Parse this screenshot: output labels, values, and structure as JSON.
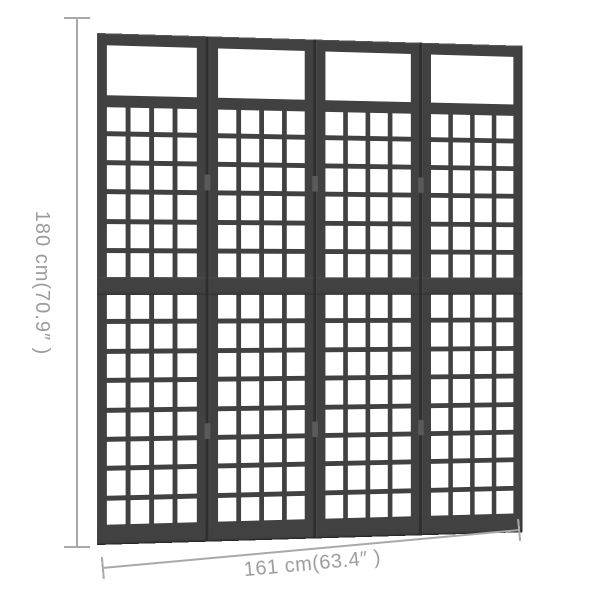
{
  "page": {
    "background": "#ffffff"
  },
  "divider": {
    "panel_count": 4,
    "columns_per_panel": 4,
    "upper_grid_rows": 6,
    "lower_grid_rows": 8,
    "hinge_offsets_px": [
      140,
      392
    ],
    "frame_color": "#414141",
    "seam_color": "#2d2d2d",
    "opening_color": "#ffffff"
  },
  "dimensions": {
    "height": {
      "label": "180 cm(70.9″ )",
      "value_cm": "180",
      "value_in": "70.9"
    },
    "width": {
      "label": "161 cm(63.4″ )",
      "value_cm": "161",
      "value_in": "63.4"
    },
    "line_color": "#a9a9a9",
    "text_color": "#9c9c9c"
  }
}
